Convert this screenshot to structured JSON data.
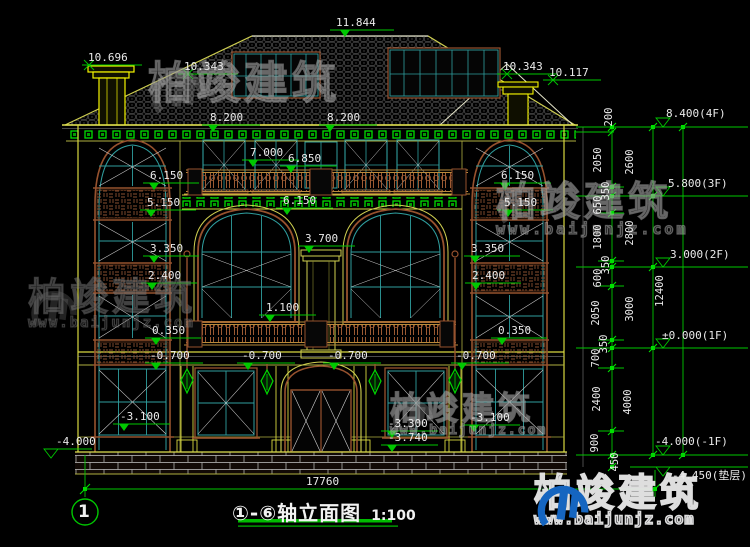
{
  "watermark": {
    "brand": "柏竣建筑",
    "url": "www.baijunjz.com"
  },
  "title": {
    "axes": "①-⑥",
    "name": "轴立面图",
    "scale": "1:100"
  },
  "axis_bubble": "1",
  "dims": {
    "overall": "17760",
    "chain_inner": [
      "200",
      "2050",
      "350",
      "650",
      "1800",
      "350",
      "600",
      "2050",
      "350",
      "700",
      "2400",
      "900",
      "450"
    ],
    "chain_mid": [
      "2600",
      "2800",
      "3000",
      "4000"
    ],
    "chain_total": "12400"
  },
  "levels": {
    "f4": "8.400(4F)",
    "f3": "5.800(3F)",
    "f2": "3.000(2F)",
    "f1": "±0.000(1F)",
    "b1": "-4.000(-1F)",
    "cushion": "-4.450(垫层)"
  },
  "elevations": {
    "chimney_left": "10.696",
    "roof_left": "10.343",
    "ridge": "11.844",
    "roof_right": "10.343",
    "chimney_right": "10.117",
    "eave_a": "8.200",
    "eave_b": "8.200",
    "attic_a": "7.000",
    "attic_b": "6.850",
    "w6150_left": "6.150",
    "w6150_center": "6.150",
    "w6150_right": "6.150",
    "w5150_left": "5.150",
    "w5150_right": "5.150",
    "w3700": "3.700",
    "w3350_left": "3.350",
    "w3350_right": "3.350",
    "w2400_left": "2.400",
    "w2400_right": "2.400",
    "w1100": "1.100",
    "w0350_left": "0.350",
    "w0350_right": "0.350",
    "wm0700_a": "-0.700",
    "wm0700_b": "-0.700",
    "wm0700_c": "-0.700",
    "wm0700_d": "-0.700",
    "wm3100_left": "-3.100",
    "wm3100_right": "-3.100",
    "wm3300": "-3.300",
    "wm3740": "-3.740",
    "wm4000": "-4.000"
  }
}
